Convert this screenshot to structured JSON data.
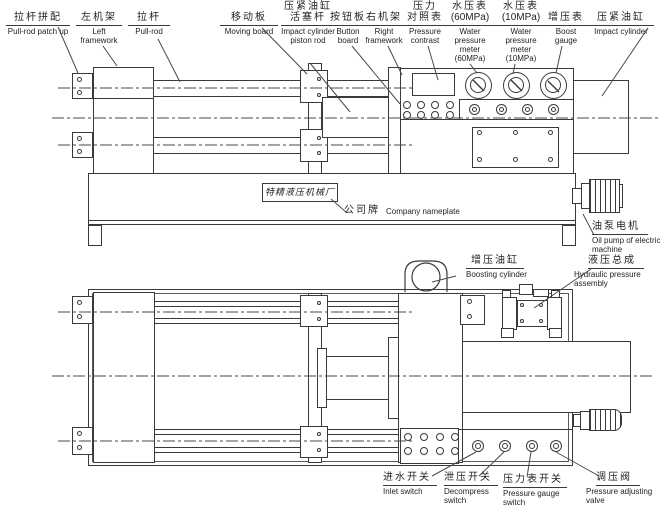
{
  "nameplate": {
    "text": "特精液压机械厂"
  },
  "callouts": [
    {
      "id": "pull-rod-patch-up",
      "zh": "拉杆拼配",
      "en": "Pull-rod patch up"
    },
    {
      "id": "left-framework",
      "zh": "左机架",
      "en": "Left framework"
    },
    {
      "id": "pull-rod",
      "zh": "拉杆",
      "en": "Pull-rod"
    },
    {
      "id": "moving-board",
      "zh": "移动板",
      "en": "Moving board"
    },
    {
      "id": "impact-cylinder-piston-rod",
      "zh": "压紧油缸",
      "zh2": "活塞杆",
      "en": "Impact cylinder piston rod"
    },
    {
      "id": "button-board",
      "zh": "按钮板",
      "en": "Button board"
    },
    {
      "id": "right-framework",
      "zh": "右机架",
      "en": "Right framework"
    },
    {
      "id": "pressure-contrast",
      "zh": "压力",
      "zh2": "对照表",
      "en": "Pressure contrast"
    },
    {
      "id": "water-pressure-meter-60",
      "zh": "水压表",
      "zh2": "(60MPa)",
      "en": "Water pressure meter (60MPa)"
    },
    {
      "id": "water-pressure-meter-10",
      "zh": "水压表",
      "zh2": "(10MPa)",
      "en": "Water pressure meter (10MPa)"
    },
    {
      "id": "boost-gauge",
      "zh": "增压表",
      "en": "Boost gauge"
    },
    {
      "id": "impact-cylinder",
      "zh": "压紧油缸",
      "en": "Impact cylinder"
    },
    {
      "id": "company-nameplate",
      "zh": "公司牌",
      "en": "Company nameplate"
    },
    {
      "id": "boosting-cylinder",
      "zh": "增压油缸",
      "en": "Boosting cylinder"
    },
    {
      "id": "oil-pump",
      "zh": "油泵电机",
      "en": "Oil pump of electric machine"
    },
    {
      "id": "hydraulic-assembly",
      "zh": "液压总成",
      "en": "Hydraulic pressure assembly"
    },
    {
      "id": "inlet-switch",
      "zh": "进水开关",
      "en": "Inlet switch"
    },
    {
      "id": "decompress-switch",
      "zh": "泄压开关",
      "en": "Decompress switch"
    },
    {
      "id": "pressure-gauge-switch",
      "zh": "压力表开关",
      "en": "Pressure gauge switch"
    },
    {
      "id": "pressure-adjusting-valve",
      "zh": "调压阀",
      "en": "Pressure adjusting valve"
    }
  ],
  "colors": {
    "line": "#3a3a3a",
    "text": "#1f1f1f",
    "background": "#ffffff"
  }
}
